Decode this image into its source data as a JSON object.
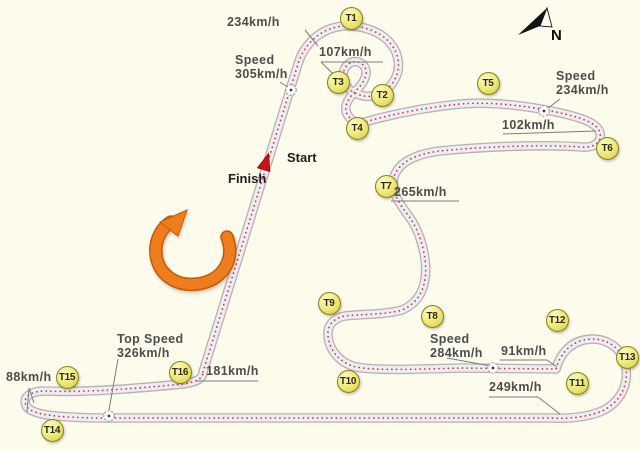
{
  "colors": {
    "background": "#fcfbec",
    "track_edge": "#b3b2b1",
    "track_surface": "#f0edf1",
    "centerline_dots": "#cc3355",
    "badge_fill": "#f0ea7e",
    "badge_border": "#84801f",
    "label_text": "#4d4d4d",
    "leader_line": "#7d7d7d",
    "direction_arrow_orange": "#ee7d1d",
    "direction_arrow_outline": "#c2590c",
    "start_marker_red": "#cc1111",
    "compass_black": "#141414"
  },
  "track": {
    "path": "M203,372 L298,64 C303,47 316,33 333,28 C353,22 379,29 391,44 C399,54 401,68 395,79 C389,91 376,98 364,96 C352,94 343,86 343,76 C343,67 350,60 358,62 C365,64 368,71 365,78 C361,88 353,92 349,99 C345,105 344,112 350,118 C355,124 364,123 372,120 C398,113 430,107 460,104 C495,101 535,107 565,114 C585,119 598,124 600,133 C602,143 593,148 582,147 C540,144 478,147 440,151 C415,154 398,163 394,177 C390,195 403,207 412,221 C421,235 428,261 425,279 C423,293 416,304 402,310 C384,315 360,314 345,316 C333,318 327,326 328,336 C329,349 339,363 356,367 C378,371 420,369 460,368 L556,369 C560,354 570,343 584,340 C604,336 620,346 625,363 C630,383 621,402 602,411 C588,417 568,419 553,418 L95,418 C62,417 34,416 27,407 C21,398 30,391 45,391 C90,393 150,387 183,384 C196,382 203,379 203,372 Z",
    "speed_markers": [
      [
        291,
        90
      ],
      [
        544,
        111
      ],
      [
        493,
        368
      ],
      [
        109,
        416
      ]
    ]
  },
  "turns": [
    {
      "id": "T1",
      "x": 351,
      "y": 18
    },
    {
      "id": "T2",
      "x": 382,
      "y": 95
    },
    {
      "id": "T3",
      "x": 338,
      "y": 82
    },
    {
      "id": "T4",
      "x": 357,
      "y": 128
    },
    {
      "id": "T5",
      "x": 488,
      "y": 83
    },
    {
      "id": "T6",
      "x": 607,
      "y": 148
    },
    {
      "id": "T7",
      "x": 386,
      "y": 186
    },
    {
      "id": "T8",
      "x": 432,
      "y": 316
    },
    {
      "id": "T9",
      "x": 329,
      "y": 303
    },
    {
      "id": "T10",
      "x": 348,
      "y": 381
    },
    {
      "id": "T11",
      "x": 577,
      "y": 383
    },
    {
      "id": "T12",
      "x": 557,
      "y": 320
    },
    {
      "id": "T13",
      "x": 627,
      "y": 357
    },
    {
      "id": "T14",
      "x": 52,
      "y": 430
    },
    {
      "id": "T15",
      "x": 67,
      "y": 377
    },
    {
      "id": "T16",
      "x": 180,
      "y": 372
    }
  ],
  "speed_labels": [
    {
      "id": "234-top",
      "x": 227,
      "y": 16,
      "lines": [
        "234km/h"
      ],
      "leaders": [
        [
          305,
          30,
          318,
          46
        ]
      ]
    },
    {
      "id": "107",
      "x": 319,
      "y": 46,
      "lines": [
        "107km/h"
      ],
      "leaders": [
        [
          321,
          62,
          383,
          62
        ],
        [
          321,
          62,
          333,
          74
        ]
      ]
    },
    {
      "id": "305",
      "x": 235,
      "y": 54,
      "lines": [
        "Speed",
        "305km/h"
      ],
      "leaders": [
        [
          280,
          82,
          289,
          88
        ]
      ]
    },
    {
      "id": "234-right",
      "x": 556,
      "y": 70,
      "lines": [
        "Speed",
        "234km/h"
      ],
      "leaders": [
        [
          560,
          99,
          547,
          109
        ]
      ]
    },
    {
      "id": "102",
      "x": 502,
      "y": 119,
      "lines": [
        "102km/h"
      ],
      "leaders": [
        [
          503,
          134,
          596,
          131
        ]
      ]
    },
    {
      "id": "265",
      "x": 394,
      "y": 186,
      "lines": [
        "265km/h"
      ],
      "leaders": [
        [
          391,
          201,
          459,
          201
        ]
      ]
    },
    {
      "id": "284",
      "x": 430,
      "y": 333,
      "lines": [
        "Speed",
        "284km/h"
      ],
      "leaders": [
        [
          447,
          358,
          491,
          366
        ]
      ]
    },
    {
      "id": "91",
      "x": 501,
      "y": 345,
      "lines": [
        "91km/h"
      ],
      "leaders": [
        [
          500,
          360,
          547,
          360
        ],
        [
          547,
          360,
          557,
          367
        ]
      ]
    },
    {
      "id": "249",
      "x": 489,
      "y": 381,
      "lines": [
        "249km/h"
      ],
      "leaders": [
        [
          489,
          397,
          538,
          397
        ],
        [
          538,
          397,
          560,
          414
        ]
      ]
    },
    {
      "id": "326",
      "x": 117,
      "y": 333,
      "lines": [
        "Top Speed",
        "326km/h"
      ],
      "leaders": [
        [
          118,
          359,
          109,
          410
        ]
      ]
    },
    {
      "id": "88",
      "x": 6,
      "y": 371,
      "lines": [
        "88km/h"
      ],
      "leaders": [
        [
          29,
          388,
          34,
          403
        ],
        [
          29,
          388,
          27,
          412
        ]
      ]
    },
    {
      "id": "181",
      "x": 206,
      "y": 365,
      "lines": [
        "181km/h"
      ],
      "leaders": [
        [
          196,
          381,
          258,
          381
        ]
      ]
    }
  ],
  "start_finish": {
    "start_label": "Start",
    "finish_label": "Finish"
  },
  "compass": {
    "north_label": "N"
  }
}
